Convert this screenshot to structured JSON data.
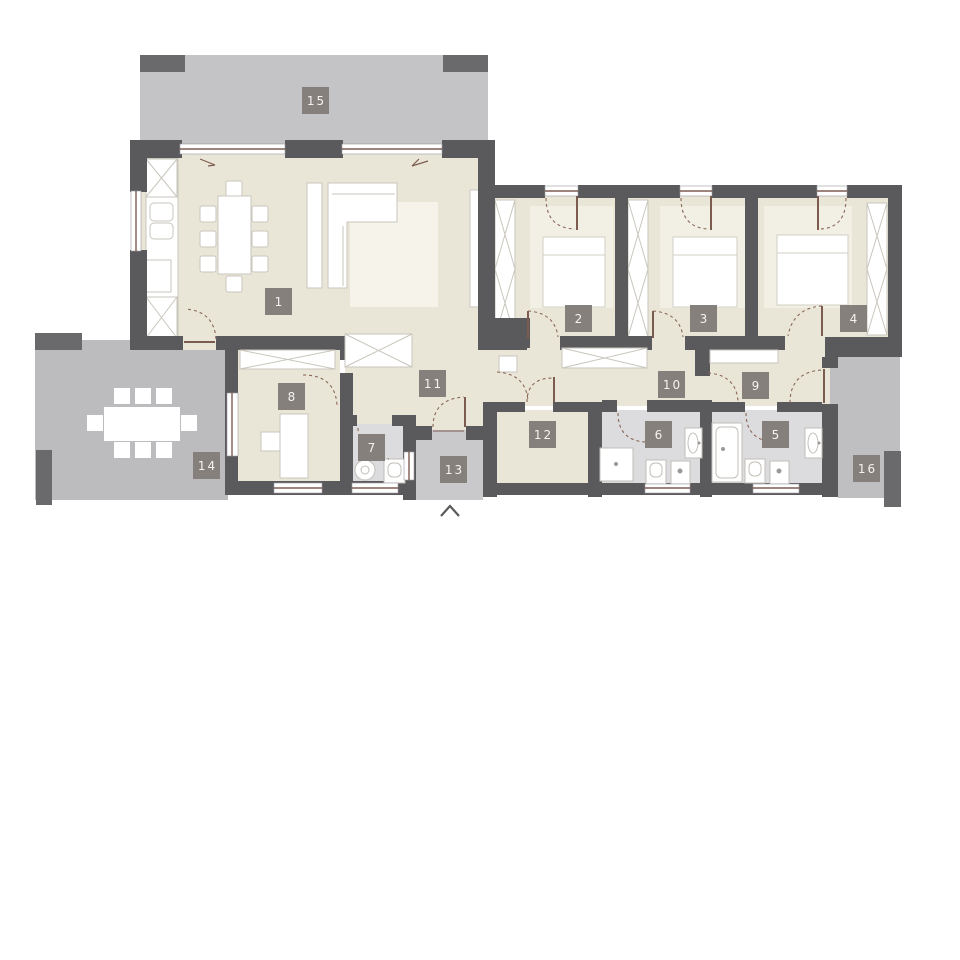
{
  "floor_plan": {
    "rooms": [
      {
        "number": "1"
      },
      {
        "number": "2"
      },
      {
        "number": "3"
      },
      {
        "number": "4"
      },
      {
        "number": "5"
      },
      {
        "number": "6"
      },
      {
        "number": "7"
      },
      {
        "number": "8"
      },
      {
        "number": "9"
      },
      {
        "number": "10"
      },
      {
        "number": "11"
      },
      {
        "number": "12"
      },
      {
        "number": "13"
      },
      {
        "number": "14"
      },
      {
        "number": "15"
      },
      {
        "number": "16"
      }
    ],
    "colors": {
      "wall": "#5a595c",
      "post": "#6a696c",
      "floor": "#eae6d7",
      "wet_floor": "#dcdbde",
      "terrace": "#c4c3c5",
      "terrace_dark": "#bcbbbd",
      "porch": "#c9c8ca",
      "badge": "#86807d",
      "door": "#7d5c50",
      "furniture_outline": "#c9c6bc"
    },
    "icons": {
      "north_arrow": "chevron-up"
    }
  }
}
